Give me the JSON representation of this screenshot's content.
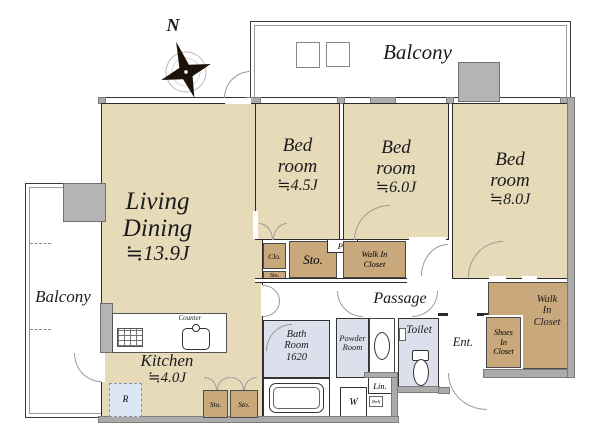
{
  "colors": {
    "room_fill": "#e6dab9",
    "closet_fill": "#c9a87c",
    "wet_fill": "#dce0ec",
    "pillar_fill": "#b4b4b4",
    "wall_gray": "#ababab",
    "fridge_fill": "#dde6f3"
  },
  "compass": {
    "north_label": "N"
  },
  "balconies": {
    "top": "Balcony",
    "left": "Balcony"
  },
  "rooms": {
    "living_dining": {
      "name_line1": "Living",
      "name_line2": "Dining",
      "size": "≒13.9J"
    },
    "kitchen": {
      "name": "Kitchen",
      "size": "≒4.0J"
    },
    "bedroom_small": {
      "name_line1": "Bed",
      "name_line2": "room",
      "size": "≒4.5J"
    },
    "bedroom_mid": {
      "name_line1": "Bed",
      "name_line2": "room",
      "size": "≒6.0J"
    },
    "bedroom_large": {
      "name_line1": "Bed",
      "name_line2": "room",
      "size": "≒8.0J"
    },
    "bath": {
      "name_line1": "Bath",
      "name_line2": "Room",
      "size": "1620"
    },
    "powder": {
      "name_line1": "Powder",
      "name_line2": "Room"
    },
    "toilet": {
      "name": "Toilet"
    },
    "entrance": {
      "name": "Ent."
    },
    "passage": {
      "name": "Passage"
    }
  },
  "storage": {
    "closet": "Clo.",
    "sto_small": "Sto.",
    "sto_big": "Sto.",
    "ps": "PS",
    "wic_mid_line1": "Walk In",
    "wic_mid_line2": "Closet",
    "wic_br_line1": "Walk",
    "wic_br_line2": "In",
    "wic_br_line3": "Closet",
    "shoes_line1": "Shoes",
    "shoes_line2": "In",
    "shoes_line3": "Closet",
    "sto_kitchen1": "Sto.",
    "sto_kitchen2": "Sto."
  },
  "fixtures": {
    "counter": "Counter",
    "washer": "W",
    "linen": "Lin.",
    "shelf": "Shelf",
    "fridge": "R"
  }
}
